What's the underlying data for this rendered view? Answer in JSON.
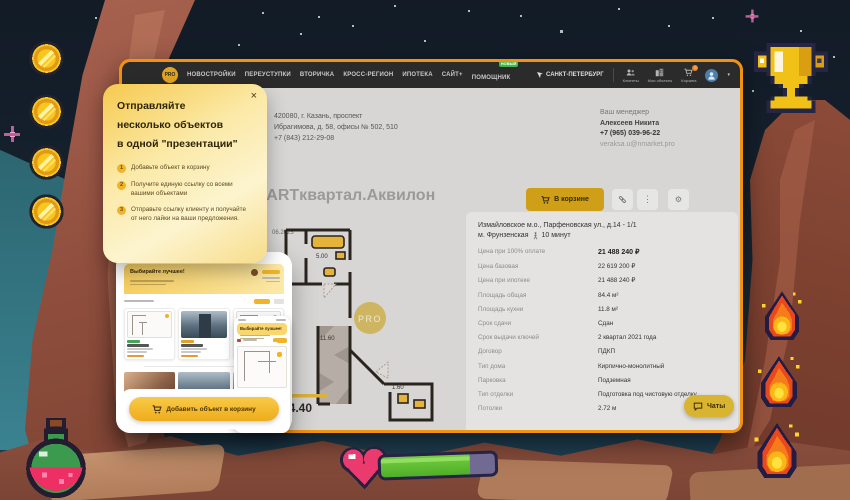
{
  "game": {
    "coins": 4,
    "flames": 3,
    "health_percent": 78
  },
  "browser": {
    "nav": {
      "logo": "PRO",
      "items": [
        "НОВОСТРОЙКИ",
        "ПЕРЕУСТУПКИ",
        "ВТОРИЧКА",
        "КРОСС-РЕГИОН",
        "ИПОТЕКА",
        "САЙТ+",
        "ПОМОЩНИК"
      ],
      "new_badge": "НОВЫЙ",
      "location": "САНКТ-ПЕТЕРБУРГ",
      "actions": [
        {
          "label": "Клиенты"
        },
        {
          "label": "Мои объекты"
        },
        {
          "label": "Корзина",
          "badge": "0"
        }
      ],
      "caret": "▾"
    },
    "office": {
      "line1": "420080, г. Казань, проспект",
      "line2": "Ибрагимова, д. 58, офисы № 502, 510",
      "phone": "+7 (843) 212-29-08"
    },
    "manager": {
      "label": "Ваш менеджер",
      "name": "Алексеев Никита",
      "phone": "+7 (965) 039-96-22",
      "email": "veraksa.u@nmarket.pro"
    },
    "listing": {
      "title": ", ARTквартал.Аквилон",
      "date": "06.2023",
      "in_cart_button": "В корзине"
    },
    "floorplan": {
      "rooms": [
        "5.00",
        "11.60",
        "1.60"
      ],
      "total": "84.40",
      "watermark": "PRO"
    },
    "details": {
      "address": "Измайловское м.о., Парфеновская ул., д.14 - 1/1",
      "metro": "м. Фрунзенская",
      "walk": "10 минут",
      "rows": [
        {
          "label": "Цена при 100% оплате",
          "value": "21 488 240 ₽"
        },
        {
          "label": "Цена базовая",
          "value": "22 619 200 ₽"
        },
        {
          "label": "Цена при ипотеке",
          "value": "21 488 240 ₽"
        },
        {
          "label": "Площадь общая",
          "value": "84.4 м²"
        },
        {
          "label": "Площадь кухни",
          "value": "11.8 м²"
        },
        {
          "label": "Срок сдачи",
          "value": "Сдан"
        },
        {
          "label": "Срок выдачи ключей",
          "value": "2 квартал 2021 года"
        },
        {
          "label": "Договор",
          "value": "ПДКП"
        },
        {
          "label": "Тип дома",
          "value": "Кирпично-монолитный"
        },
        {
          "label": "Парковка",
          "value": "Подземная"
        },
        {
          "label": "Тип отделки",
          "value": "Подготовка под чистовую отделку"
        },
        {
          "label": "Потолки",
          "value": "2.72 м"
        }
      ]
    },
    "chats_button": "Чаты"
  },
  "tooltip": {
    "close": "×",
    "title_lines": [
      "Отправляйте",
      "несколько объектов",
      "в одной \"презентации\""
    ],
    "steps": [
      {
        "num": "1",
        "text": "Добавьте объект в корзину"
      },
      {
        "num": "2",
        "text": "Получите единую ссылку со всеми вашими объектами"
      },
      {
        "num": "3",
        "text": "Отправьте ссылку клиенту и получайте от него лайки на ваши предложения."
      }
    ]
  },
  "preview": {
    "header": "Выбирайте лучшее!",
    "cta": "Добавить объект в корзину"
  }
}
